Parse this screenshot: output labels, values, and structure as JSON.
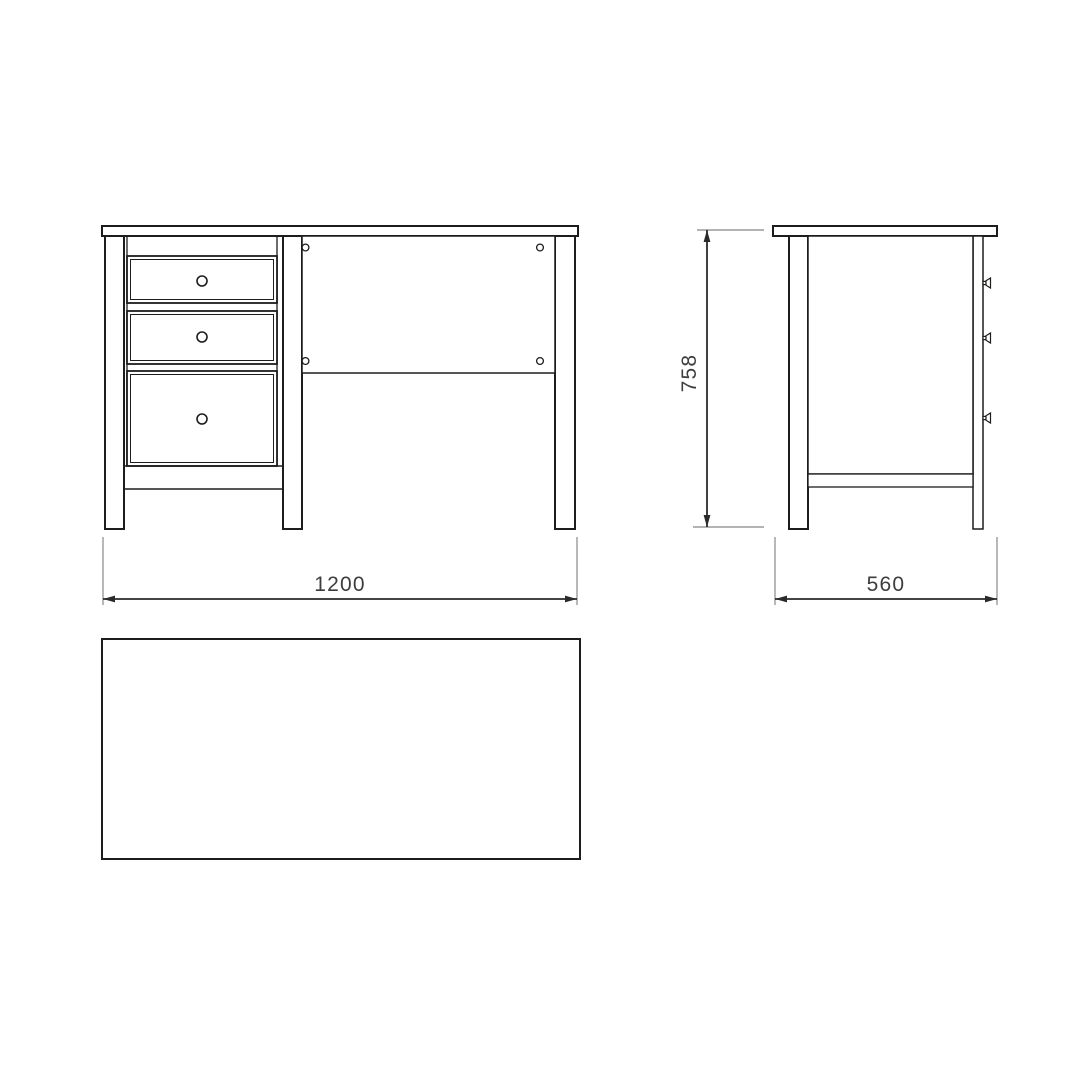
{
  "drawing": {
    "subject": "desk",
    "dimensions": {
      "width": {
        "value": "1200",
        "orientation": "horizontal",
        "applies_to": "front-view"
      },
      "depth": {
        "value": "560",
        "orientation": "horizontal",
        "applies_to": "side-view"
      },
      "height": {
        "value": "758",
        "orientation": "vertical",
        "applies_to": "side-view"
      }
    },
    "counts": {
      "front_drawers": 3,
      "drawer_knobs_front": 3,
      "drawer_knobs_side": 3,
      "panel_screw_holes": 4
    }
  },
  "colors": {
    "background": "#ffffff",
    "line": "#1d1d1b",
    "dimension_line": "#2a2a2a",
    "extension_line": "#9a9a9a",
    "dimension_text": "#3d3d3d"
  }
}
